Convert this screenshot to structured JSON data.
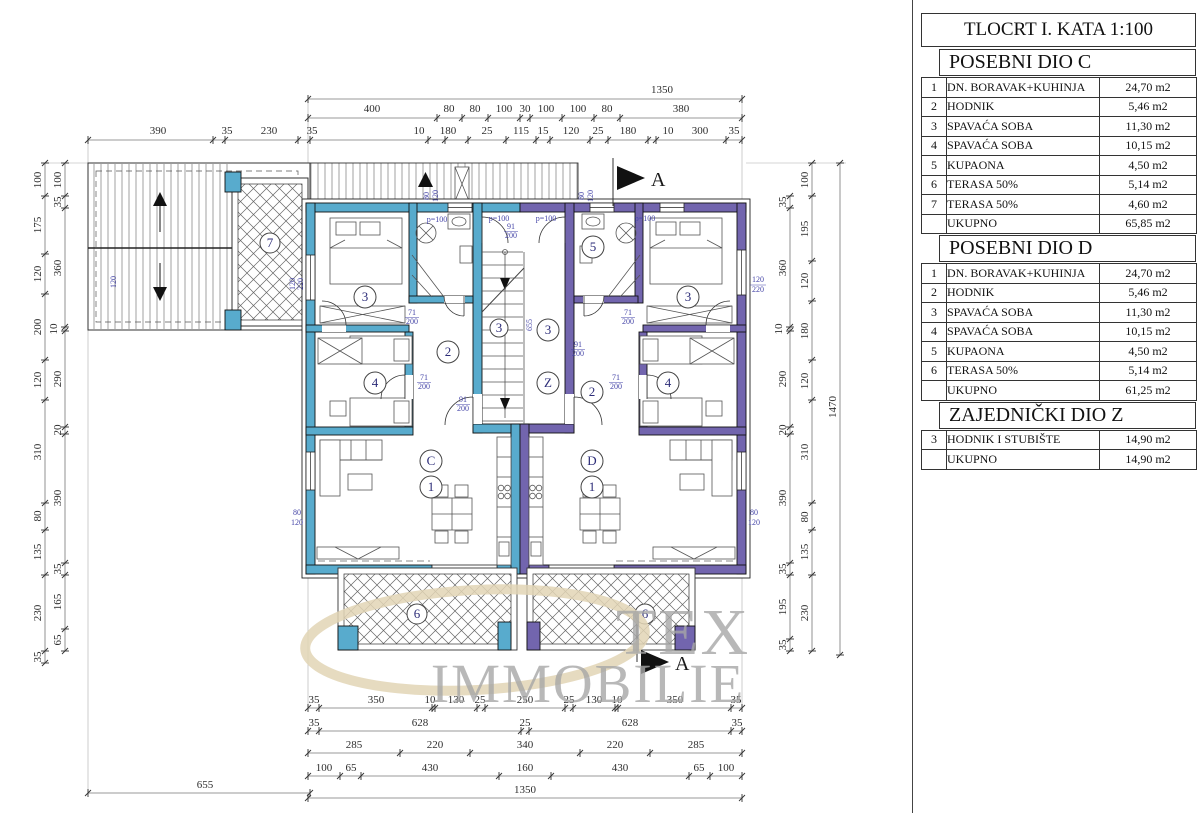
{
  "panel": {
    "title": "TLOCRT I. KATA 1:100",
    "sections": [
      {
        "heading": "POSEBNI DIO C",
        "rows": [
          {
            "num": "1",
            "name": "DN. BORAVAK+KUHINJA",
            "area": "24,70 m2"
          },
          {
            "num": "2",
            "name": "HODNIK",
            "area": "5,46 m2"
          },
          {
            "num": "3",
            "name": "SPAVAĆA SOBA",
            "area": "11,30 m2"
          },
          {
            "num": "4",
            "name": "SPAVAĆA SOBA",
            "area": "10,15 m2"
          },
          {
            "num": "5",
            "name": "KUPAONA",
            "area": "4,50 m2"
          },
          {
            "num": "6",
            "name": "TERASA 50%",
            "area": "5,14 m2"
          },
          {
            "num": "7",
            "name": "TERASA 50%",
            "area": "4,60 m2"
          },
          {
            "num": "",
            "name": "UKUPNO",
            "area": "65,85 m2"
          }
        ]
      },
      {
        "heading": "POSEBNI DIO D",
        "rows": [
          {
            "num": "1",
            "name": "DN. BORAVAK+KUHINJA",
            "area": "24,70 m2"
          },
          {
            "num": "2",
            "name": "HODNIK",
            "area": "5,46 m2"
          },
          {
            "num": "3",
            "name": "SPAVAĆA SOBA",
            "area": "11,30 m2"
          },
          {
            "num": "4",
            "name": "SPAVAĆA SOBA",
            "area": "10,15 m2"
          },
          {
            "num": "5",
            "name": "KUPAONA",
            "area": "4,50 m2"
          },
          {
            "num": "6",
            "name": "TERASA 50%",
            "area": "5,14 m2"
          },
          {
            "num": "",
            "name": "UKUPNO",
            "area": "61,25 m2"
          }
        ]
      },
      {
        "heading": "ZAJEDNIČKI DIO Z",
        "rows": [
          {
            "num": "3",
            "name": "HODNIK I STUBIŠTE",
            "area": "14,90 m2"
          },
          {
            "num": "",
            "name": "UKUPNO",
            "area": "14,90 m2"
          }
        ]
      }
    ]
  },
  "dims": {
    "top1": [
      "1350"
    ],
    "top2": [
      "400",
      "80",
      "80",
      "100",
      "30",
      "100",
      "100",
      "80",
      "380"
    ],
    "top3": [
      "390",
      "35",
      "230",
      "35",
      "10",
      "180",
      "25",
      "115",
      "15",
      "120",
      "25",
      "180",
      "10",
      "300",
      "35"
    ],
    "left_outer": [
      "100",
      "175",
      "120",
      "200",
      "120",
      "310",
      "80",
      "135",
      "230",
      "35"
    ],
    "left_inner": [
      "100",
      "35",
      "360",
      "10",
      "290",
      "20",
      "390",
      "35",
      "165",
      "65"
    ],
    "right_inner": [
      "35",
      "360",
      "10",
      "290",
      "20",
      "390",
      "35",
      "195",
      "35"
    ],
    "right_mid": [
      "100",
      "195",
      "120",
      "180",
      "120",
      "310",
      "80",
      "135",
      "230"
    ],
    "right_outer": [
      "1470"
    ],
    "bottom1": [
      "35",
      "350",
      "10",
      "130",
      "25",
      "250",
      "25",
      "130",
      "10",
      "350",
      "35"
    ],
    "bottom2": [
      "35",
      "628",
      "25",
      "628",
      "35"
    ],
    "bottom3": [
      "285",
      "220",
      "340",
      "220",
      "285"
    ],
    "bottom4": [
      "100",
      "65",
      "430",
      "160",
      "430",
      "65",
      "100"
    ],
    "bottom5": [
      "1350"
    ],
    "left655": [
      "655"
    ]
  },
  "plan": {
    "circles": {
      "one": "1",
      "two": "2",
      "three": "3",
      "four": "4",
      "five": "5",
      "six": "6",
      "seven": "7",
      "c": "C",
      "d": "D",
      "z": "Z"
    },
    "ann": {
      "a80": "80",
      "a120": "120",
      "a220": "220",
      "p100": "p=100",
      "a91": "91",
      "a200": "200",
      "a71": "71",
      "a655": "655"
    },
    "section_label": "A"
  },
  "watermark": {
    "line1": "TEX",
    "line2": "IMMOBILIE"
  },
  "colors": {
    "unit_c": "#58abcd",
    "unit_d": "#7265ae",
    "annotation": "#4747a8",
    "watermark_swoosh": "#e2d5b5",
    "watermark_text": "#a7a7a7"
  }
}
